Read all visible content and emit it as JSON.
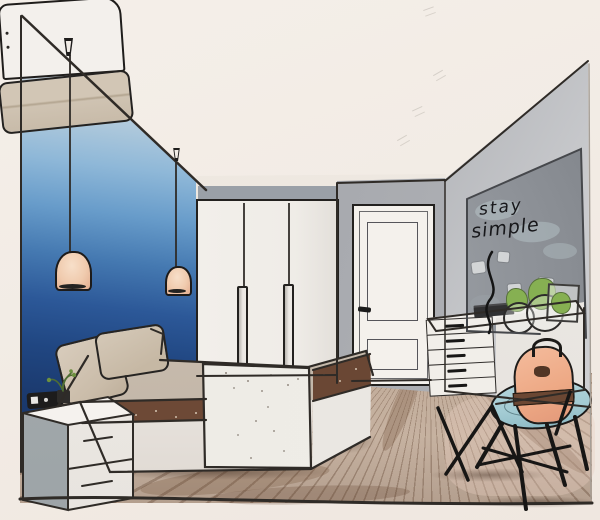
{
  "artwork": {
    "title": "Bedroom interior watercolor sketch",
    "style": "one-point perspective ink and watercolor drawing",
    "wall_art": {
      "line1": "stay",
      "line2": "simple"
    },
    "palette": {
      "paper": "#f2ece6",
      "ombre_wall_top": "#c9c2bc",
      "ombre_wall_navy": "#16305d",
      "gray_wall": "#a6a8ad",
      "art_board_gray": "#84888e",
      "lamp_shade_peach": "#f0cbae",
      "bed_stripe_brown": "#6d4936",
      "mattress_taupe": "#c7bbad",
      "floor_wood": "#c6b2a0",
      "stool_seat_blue": "#a3cbd3",
      "backpack_peach": "#eda884",
      "plant_green": "#86b052"
    },
    "objects": [
      "ombre-accent-wall",
      "pendant-lamp",
      "pendant-lamp",
      "bed",
      "headboard",
      "pillow",
      "pillow",
      "folded-duvet",
      "white-runner",
      "nightstand",
      "radio",
      "potted-plant",
      "wardrobe",
      "paneled-door",
      "stay-simple-board",
      "polaroid-photos",
      "dresser",
      "books",
      "glass-vases-with-plants",
      "stool",
      "backpack",
      "wood-plank-floor"
    ]
  }
}
